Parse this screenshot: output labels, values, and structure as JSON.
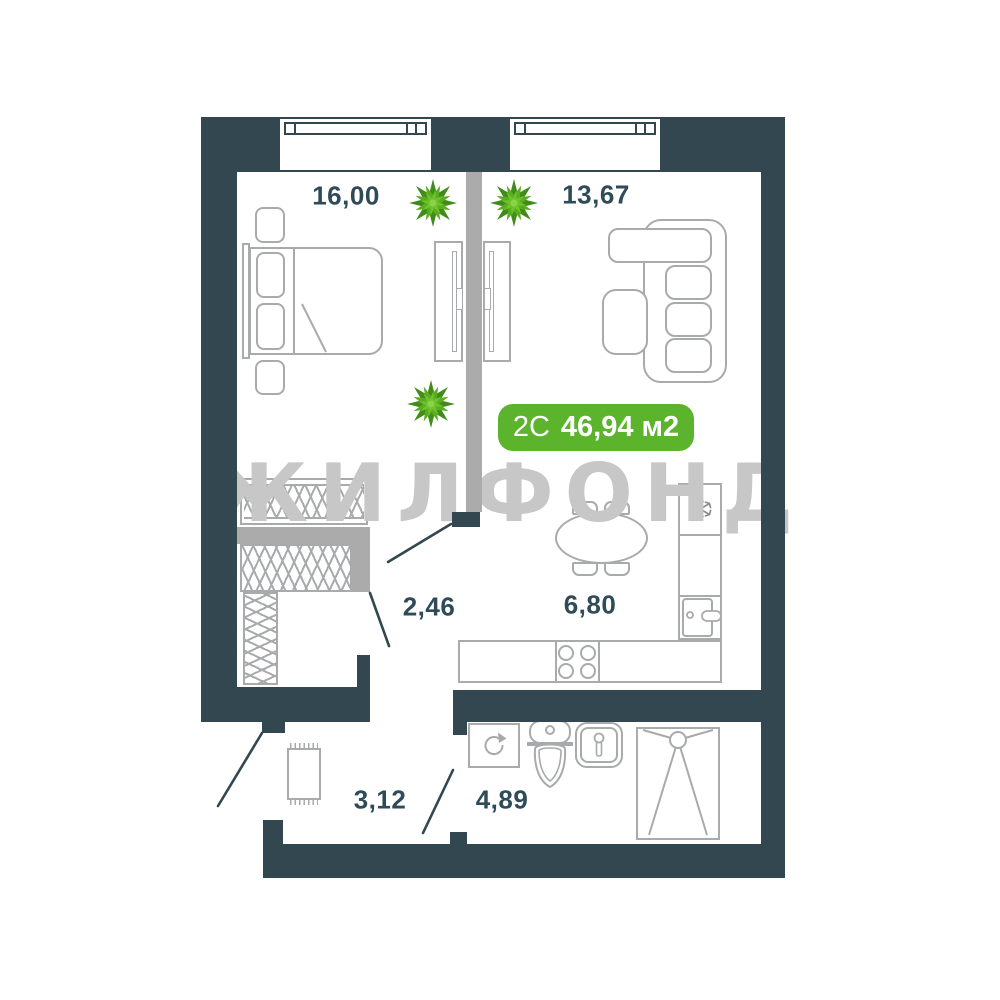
{
  "title": "apartment-floor-plan",
  "badge": {
    "type_label": "2С",
    "area_label": "46,94 м2"
  },
  "watermark_text": "ЖИЛФОНД",
  "rooms": [
    {
      "id": "bedroom",
      "area": "16,00"
    },
    {
      "id": "living-room",
      "area": "13,67"
    },
    {
      "id": "hall",
      "area": "2,46"
    },
    {
      "id": "kitchen",
      "area": "6,80"
    },
    {
      "id": "corridor",
      "area": "3,12"
    },
    {
      "id": "bathroom",
      "area": "4,89"
    }
  ],
  "icons": [
    "plant-icon",
    "snowflake-icon",
    "washing-machine-arrow-icon",
    "toilet-icon",
    "sink-icon",
    "shower-icon"
  ],
  "colors": {
    "wall": "#32474F",
    "partition": "#ABABAB",
    "furniture": "#A8AAAC",
    "label": "#2F4B58",
    "badge_green": "#5CB32C",
    "watermark_gray": "#C7C7C7"
  }
}
